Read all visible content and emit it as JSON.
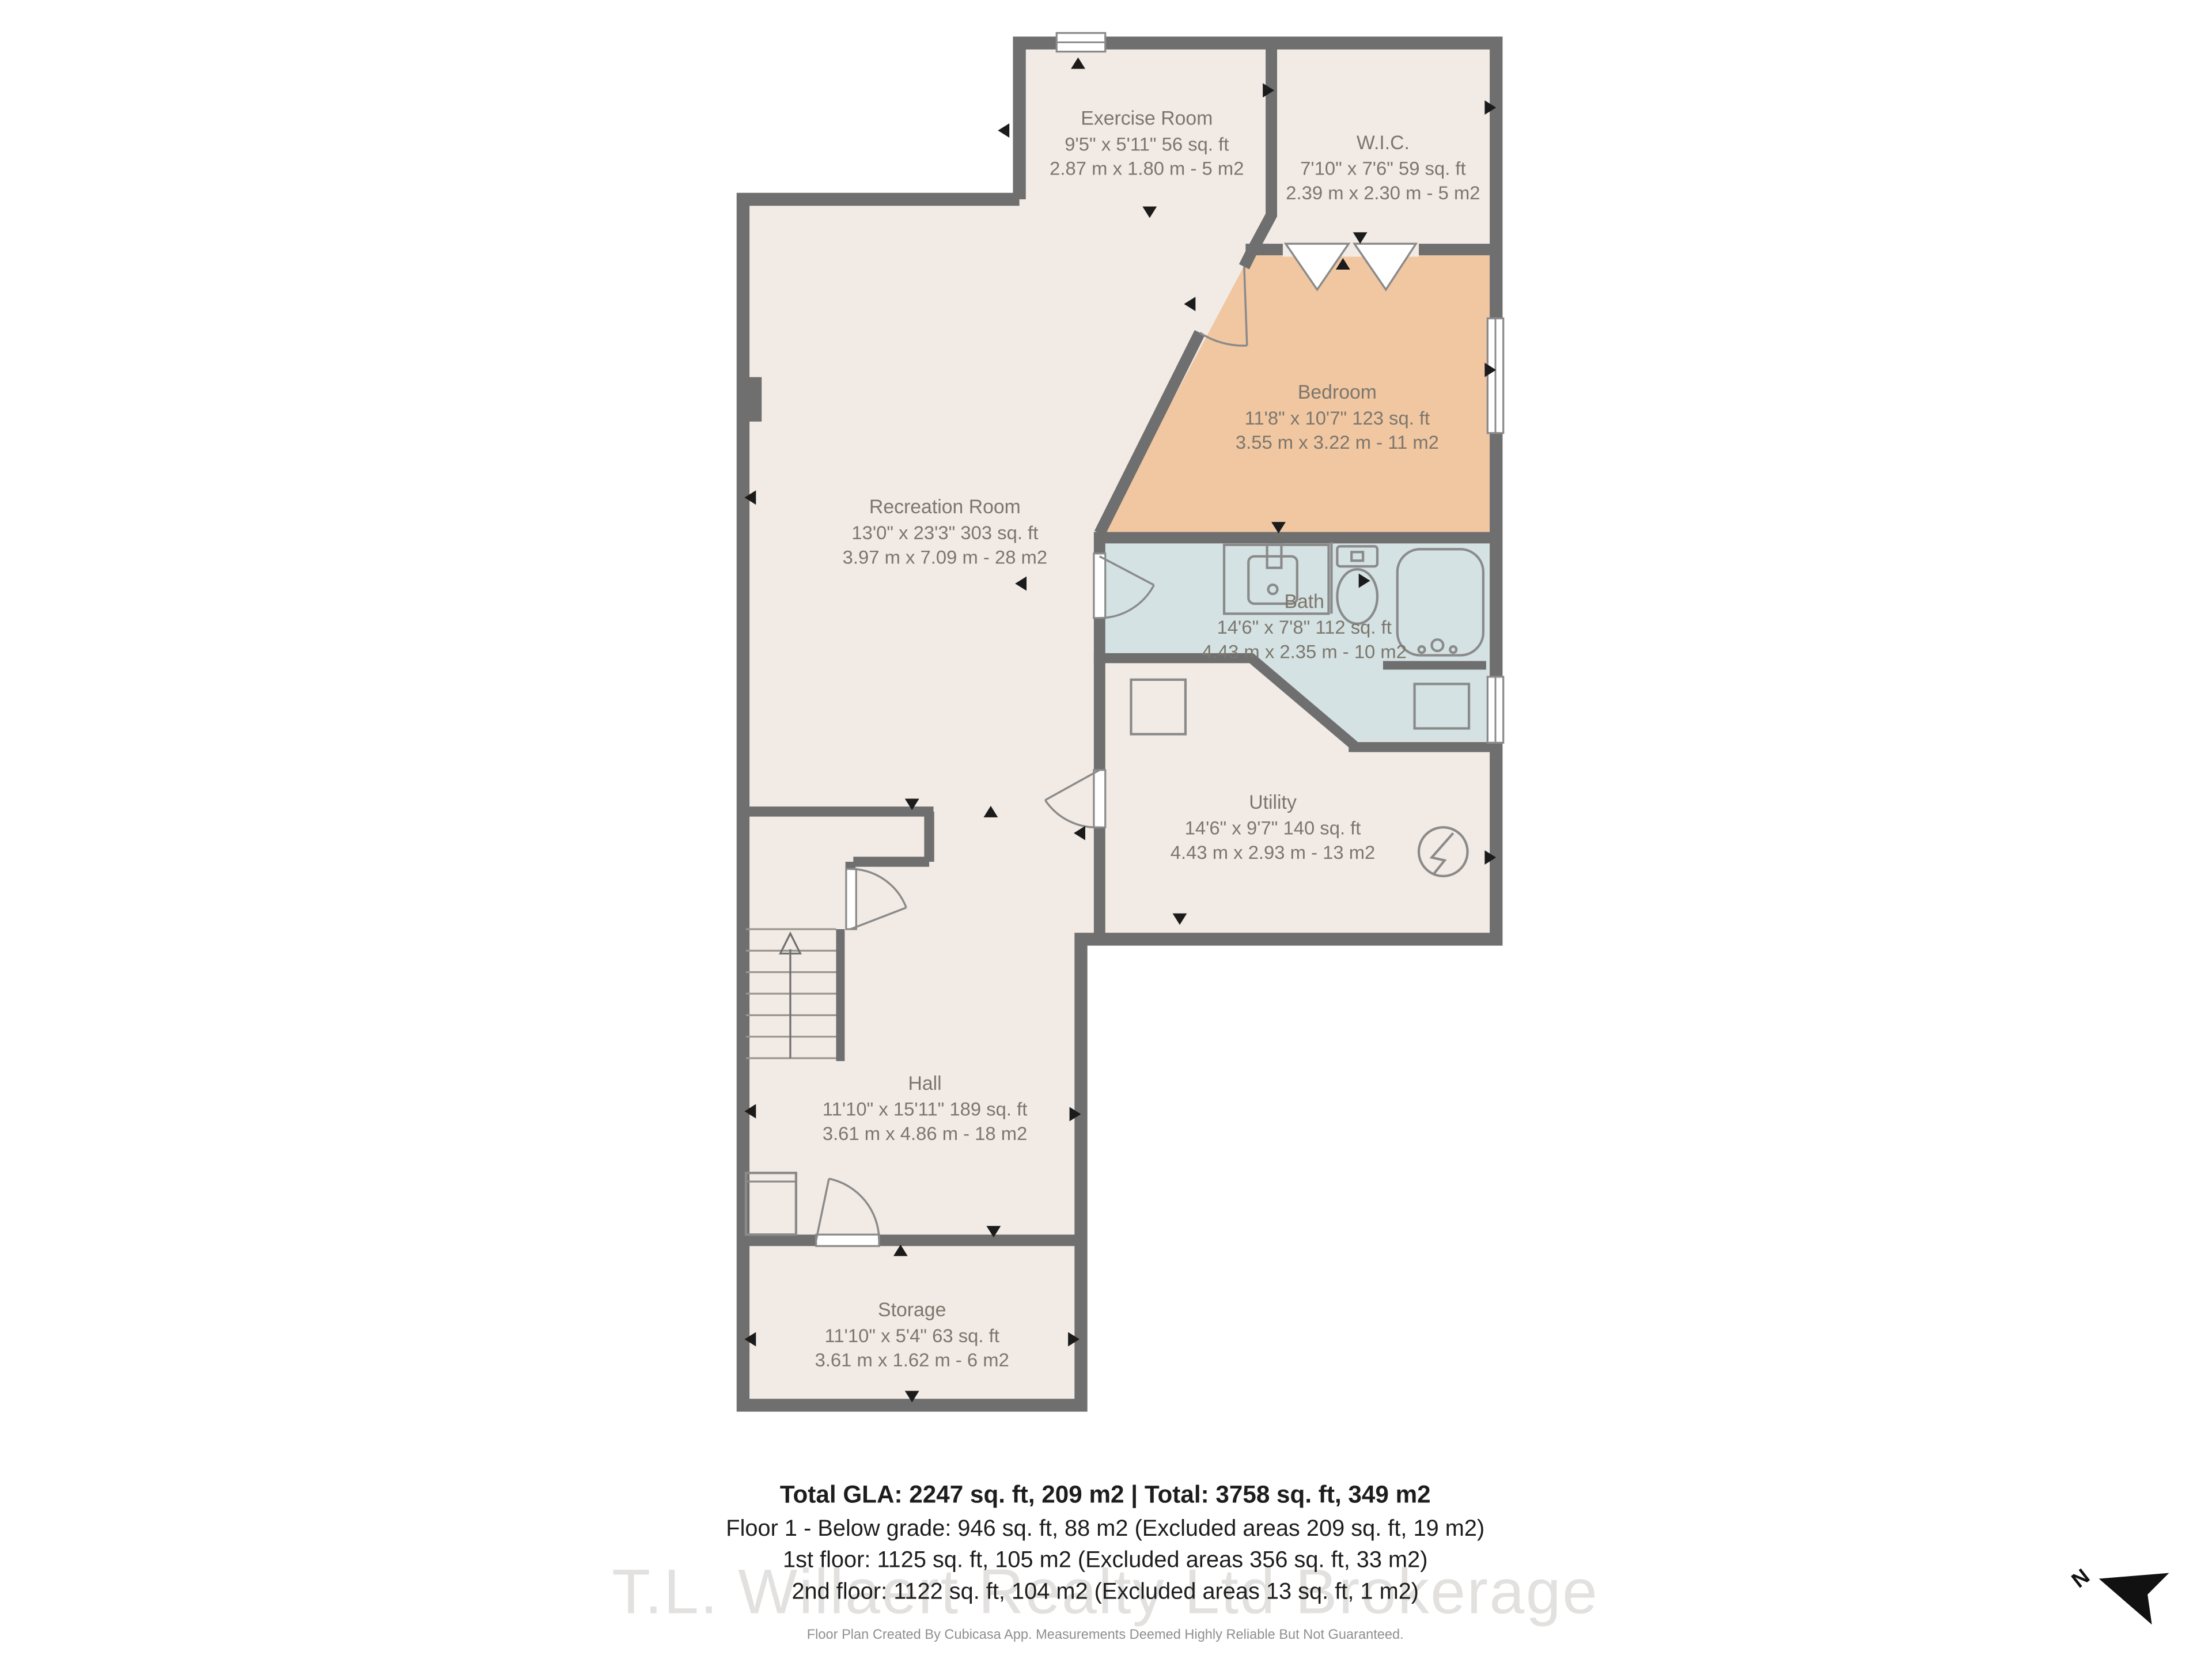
{
  "rooms": [
    {
      "name": "Exercise Room",
      "dims_ft": "9'5\" x 5'11\" 56 sq. ft",
      "dims_m": "2.87 m x 1.80 m - 5 m2"
    },
    {
      "name": "W.I.C.",
      "dims_ft": "7'10\" x 7'6\" 59 sq. ft",
      "dims_m": "2.39 m x 2.30 m - 5 m2"
    },
    {
      "name": "Bedroom",
      "dims_ft": "11'8\" x 10'7\" 123 sq. ft",
      "dims_m": "3.55 m x 3.22 m - 11 m2"
    },
    {
      "name": "Recreation Room",
      "dims_ft": "13'0\" x 23'3\" 303 sq. ft",
      "dims_m": "3.97 m x 7.09 m - 28 m2"
    },
    {
      "name": "Bath",
      "dims_ft": "14'6\" x 7'8\" 112 sq. ft",
      "dims_m": "4.43 m x 2.35 m - 10 m2"
    },
    {
      "name": "Utility",
      "dims_ft": "14'6\" x 9'7\" 140 sq. ft",
      "dims_m": "4.43 m x 2.93 m - 13 m2"
    },
    {
      "name": "Hall",
      "dims_ft": "11'10\" x 15'11\" 189 sq. ft",
      "dims_m": "3.61 m x 4.86 m - 18 m2"
    },
    {
      "name": "Storage",
      "dims_ft": "11'10\" x 5'4\" 63 sq. ft",
      "dims_m": "3.61 m x 1.62 m - 6 m2"
    }
  ],
  "summary": {
    "line1": "Total GLA: 2247 sq. ft, 209 m2 | Total: 3758 sq. ft, 349 m2",
    "line2": "Floor 1 - Below grade: 946 sq. ft, 88 m2 (Excluded areas 209 sq. ft, 19 m2)",
    "line3": "1st floor: 1125 sq. ft, 105 m2 (Excluded areas 356 sq. ft, 33 m2)",
    "line4": "2nd floor: 1122 sq. ft, 104 m2 (Excluded areas 13 sq. ft, 1 m2)"
  },
  "watermark": "T.L. Willaert Realty Ltd Brokerage",
  "disclaimer": "Floor Plan Created By Cubicasa App. Measurements Deemed Highly Reliable But Not Guaranteed.",
  "compass": {
    "label": "N"
  },
  "icons": [
    "north-arrow-icon",
    "water-heater-icon",
    "stairs-icon",
    "door-swing-icon",
    "window-icon",
    "closet-bifold-icon"
  ],
  "colors": {
    "wall": "#6f6f6f",
    "floor": "#f2ebe5",
    "bedroom": "#f0c7a1",
    "bath": "#d4e2e3"
  }
}
